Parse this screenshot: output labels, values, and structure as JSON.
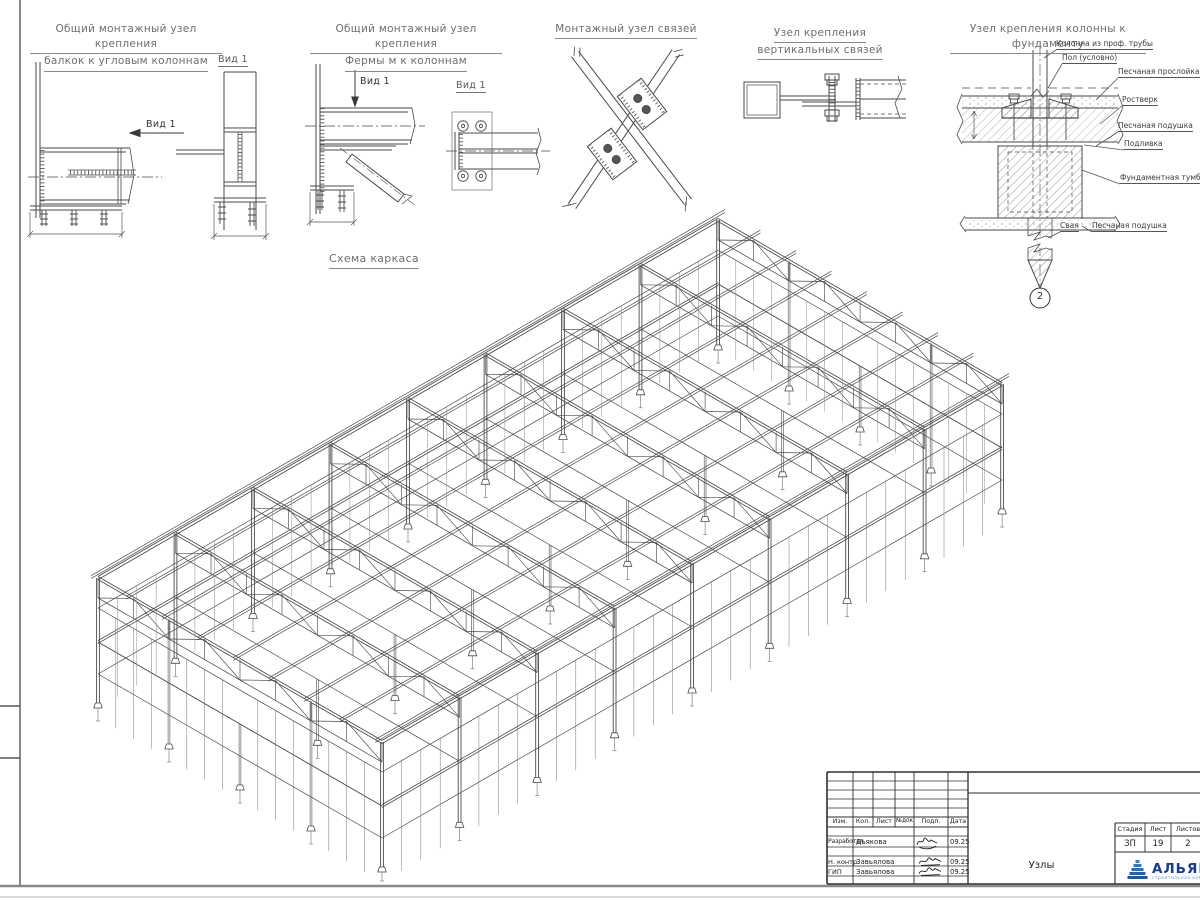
{
  "details": [
    {
      "title_lines": [
        "Общий монтажный узел крепления",
        "балкок к угловым колоннам"
      ],
      "view_label": "Вид 1",
      "view_arrow_label": "Вид 1"
    },
    {
      "title_lines": [
        "Общий монтажный узел крепления",
        "Фермы м к колоннам"
      ],
      "view_label": "Вид 1",
      "view_arrow_label": "Вид 1"
    },
    {
      "title_lines": [
        "Монтажный узел связей"
      ]
    },
    {
      "title_lines": [
        "Узел крепления",
        "вертикальных связей"
      ]
    },
    {
      "title": "Узел крепления колонны к фундаменту",
      "labels": [
        "Колонна из проф. трубы",
        "Пол (условно)",
        "Песчаная прослойка",
        "Ростверк",
        "Песчаная подушка",
        "Подливка",
        "Фундаментная тумба",
        "Свая",
        "Песчаная подушка"
      ],
      "marker": "2"
    }
  ],
  "scheme": {
    "title": "Схема каркаса",
    "iso": {
      "ox": 98,
      "oy": 708,
      "cos": 0.866,
      "sin": 0.5,
      "length": 716,
      "width": 328,
      "bays_u": 8,
      "bays_v": 4,
      "eave_h": 130,
      "floor_h": 66,
      "truss_depth": 20,
      "girts": [
        34,
        100
      ],
      "pile": 13
    }
  },
  "titleblock": {
    "header_cols": [
      "Изм.",
      "Кол.",
      "Лист",
      "№док",
      "Подп.",
      "Дата"
    ],
    "rows": [
      {
        "role": "Разработал",
        "name": "Дьякова",
        "date": "09.25"
      },
      {
        "role": "Н. контр.",
        "name": "Завьялова",
        "date": "09.25"
      },
      {
        "role": "ГИП",
        "name": "Завьялова",
        "date": "09.25"
      }
    ],
    "doc_title": "Узлы",
    "stage_label": "Стадия",
    "stage": "ЗП",
    "sheet_label": "Лист",
    "sheet_no": "19",
    "sheets_label": "Листов",
    "sheets_total": "2",
    "logo": {
      "name": "АЛЬЯНС",
      "tagline": "строительная компания",
      "color": "#1a3b8f",
      "accent": "#1e74d0"
    }
  }
}
